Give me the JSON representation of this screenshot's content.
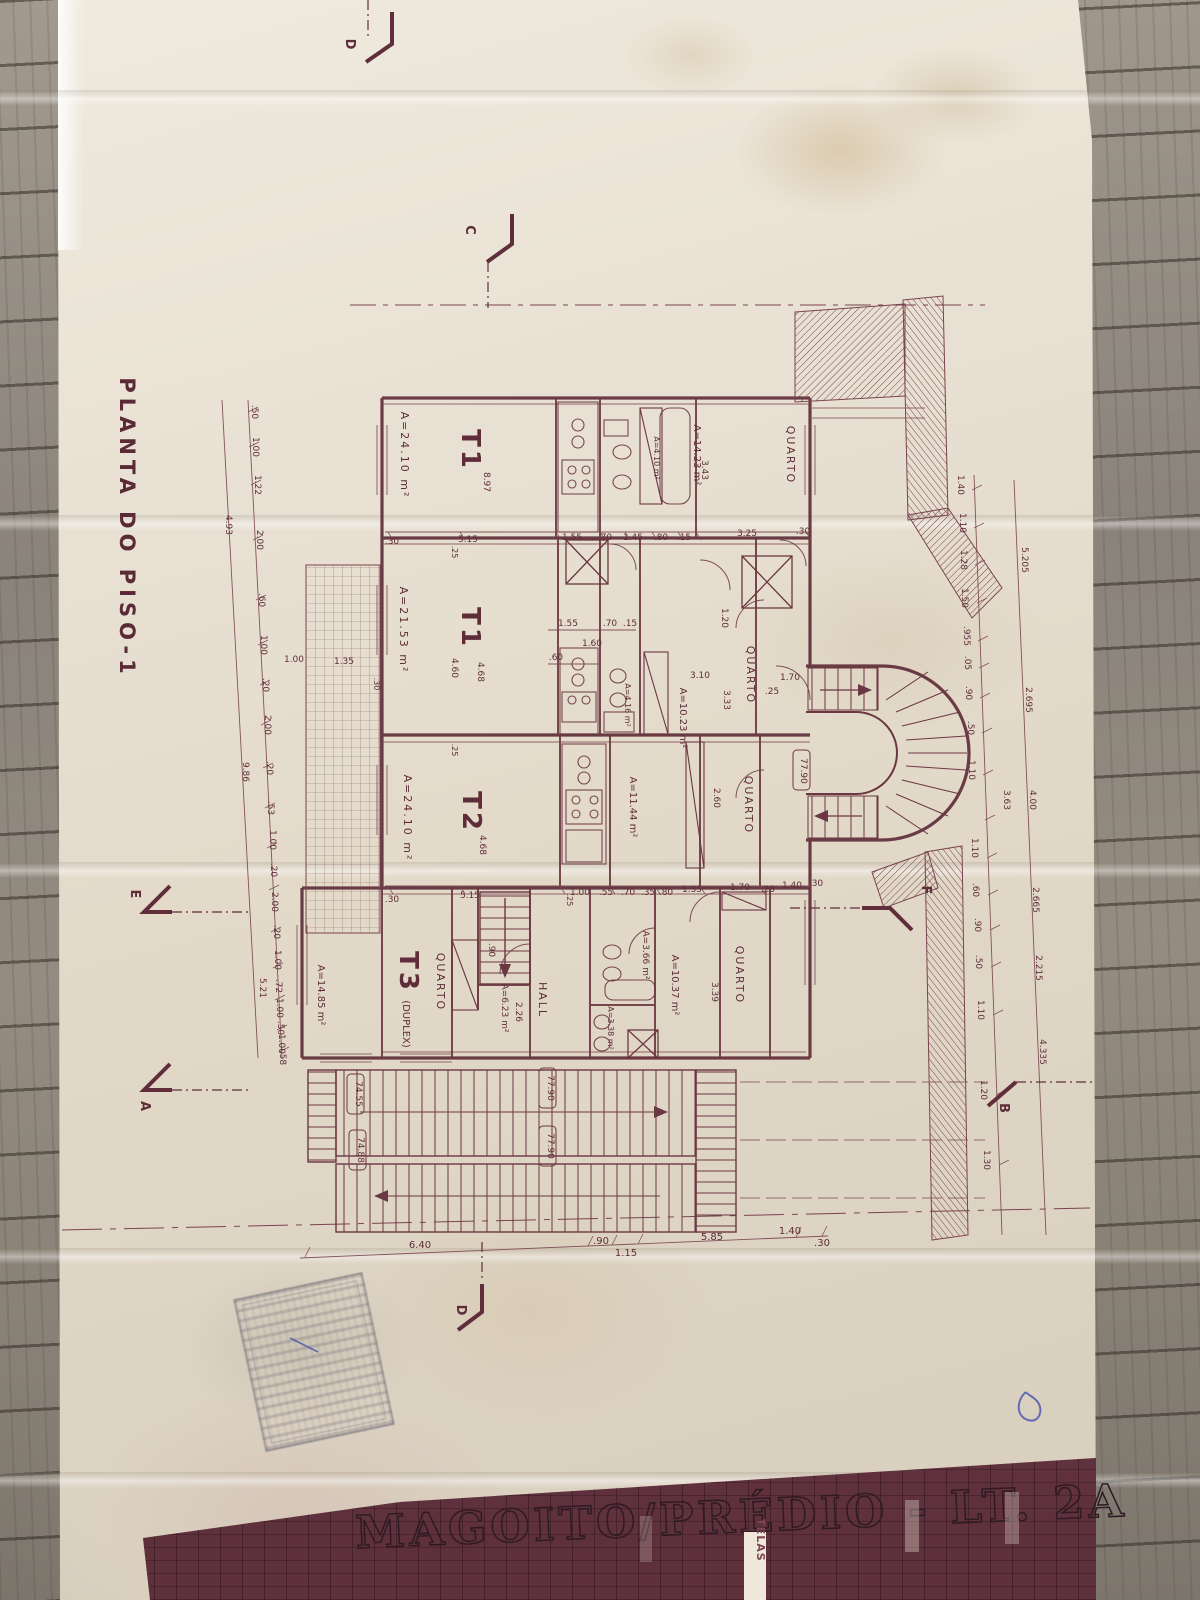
{
  "meta": {
    "plan_title": "PLANTA DO PISO-1",
    "project_title": "MAGOITO/PRÉDIO - LT. 2A",
    "telas_label": "TELAS",
    "handwritten_mark": "D",
    "ink_color": "#6b3742",
    "paper_color": "#e9e1d1",
    "strip_color": "#7a4450"
  },
  "markers": {
    "top_d": "D",
    "top_c": "C",
    "left_e": "E",
    "right_f": "F",
    "bottom_a": "A",
    "bottom_b": "B",
    "bottom_d": "D"
  },
  "rooms": {
    "t1_top": "T1",
    "t1_top_area": "A=24.10 m²",
    "quarto_top": "QUARTO",
    "quarto_top_area": "A=14.23 m²",
    "bath_top_area": "A=4.10 m²",
    "t1_mid": "T1",
    "t1_mid_area": "A=21.53 m²",
    "quarto_mid": "QUARTO",
    "quarto_mid_area": "A=10.23 m²",
    "bath_mid_area": "A=4.16 m²",
    "t2": "T2",
    "t2_area": "A=24.10 m²",
    "room_1144_area": "A=11.44 m²",
    "quarto_t2": "QUARTO",
    "t3": "T3",
    "t3_suffix": "(DUPLEX)",
    "t3_area": "A=14.85 m²",
    "quarto_t3": "QUARTO",
    "stair_area": "A=6.23 m²",
    "hall": "HALL",
    "bath_t3_area": "A=3.66 m²",
    "room_1037_area": "A=10.37 m²",
    "quarto_b": "QUARTO",
    "bath_small_area": "A=3.38 m²"
  },
  "levels": {
    "stair": "77.90",
    "f1l": "74.55",
    "f1r": "77.90",
    "f2l": "74.88",
    "f2r": "77.90"
  },
  "dims": {
    "top": [
      ".30",
      "5.15",
      "1.55",
      ".70",
      "1.45",
      ".80",
      ".15",
      "3.25",
      ".30"
    ],
    "mid": [
      ".30",
      "5.15",
      "1.00",
      ".55",
      ".70",
      ".35",
      ".80",
      "1.35",
      "1.70",
      ".25",
      "1.40",
      ".30"
    ],
    "kitchen": [
      "1.55",
      ".70",
      ".15",
      ".60",
      "1.60",
      "1.20"
    ],
    "quarto_mid": [
      "3.10",
      "3.33"
    ],
    "quarto_top": [
      "3.43"
    ],
    "t1_top": [
      "8.97"
    ],
    "t1_mid": [
      ".25",
      "4.68",
      "4.60",
      "1.00",
      "1.35",
      ".30"
    ],
    "t2": [
      ".25",
      "4.68"
    ],
    "t3": [
      "2.26",
      ".90",
      ".25",
      "3.39",
      "2.60"
    ],
    "stair": [
      "1.70",
      ".25"
    ],
    "bottom": [
      "6.40",
      ".90",
      "1.15",
      "5.85",
      "1.40",
      ".30"
    ],
    "left": [
      ".50",
      "1.00",
      "1.22",
      "2.00",
      ".60",
      "1.00",
      ".20",
      "2.00",
      ".20",
      ".53",
      "1.00",
      ".20",
      "2.00",
      ".20",
      "1.00",
      ".72",
      "1.00",
      ".50",
      "1.00",
      ".58"
    ],
    "left_totals": [
      "4.93",
      "9.86",
      "5.21"
    ],
    "right": [
      "1.40",
      "1.10",
      "1.28",
      "1.50",
      ".955",
      ".05",
      ".90",
      ".50",
      "1.10",
      "3.63",
      "1.10",
      ".60",
      ".90",
      ".50",
      "1.10",
      "1.20",
      "1.30"
    ],
    "right_totals": [
      "5.205",
      "2.695",
      "4.00",
      "2.665",
      "2.215",
      "4.335"
    ]
  }
}
